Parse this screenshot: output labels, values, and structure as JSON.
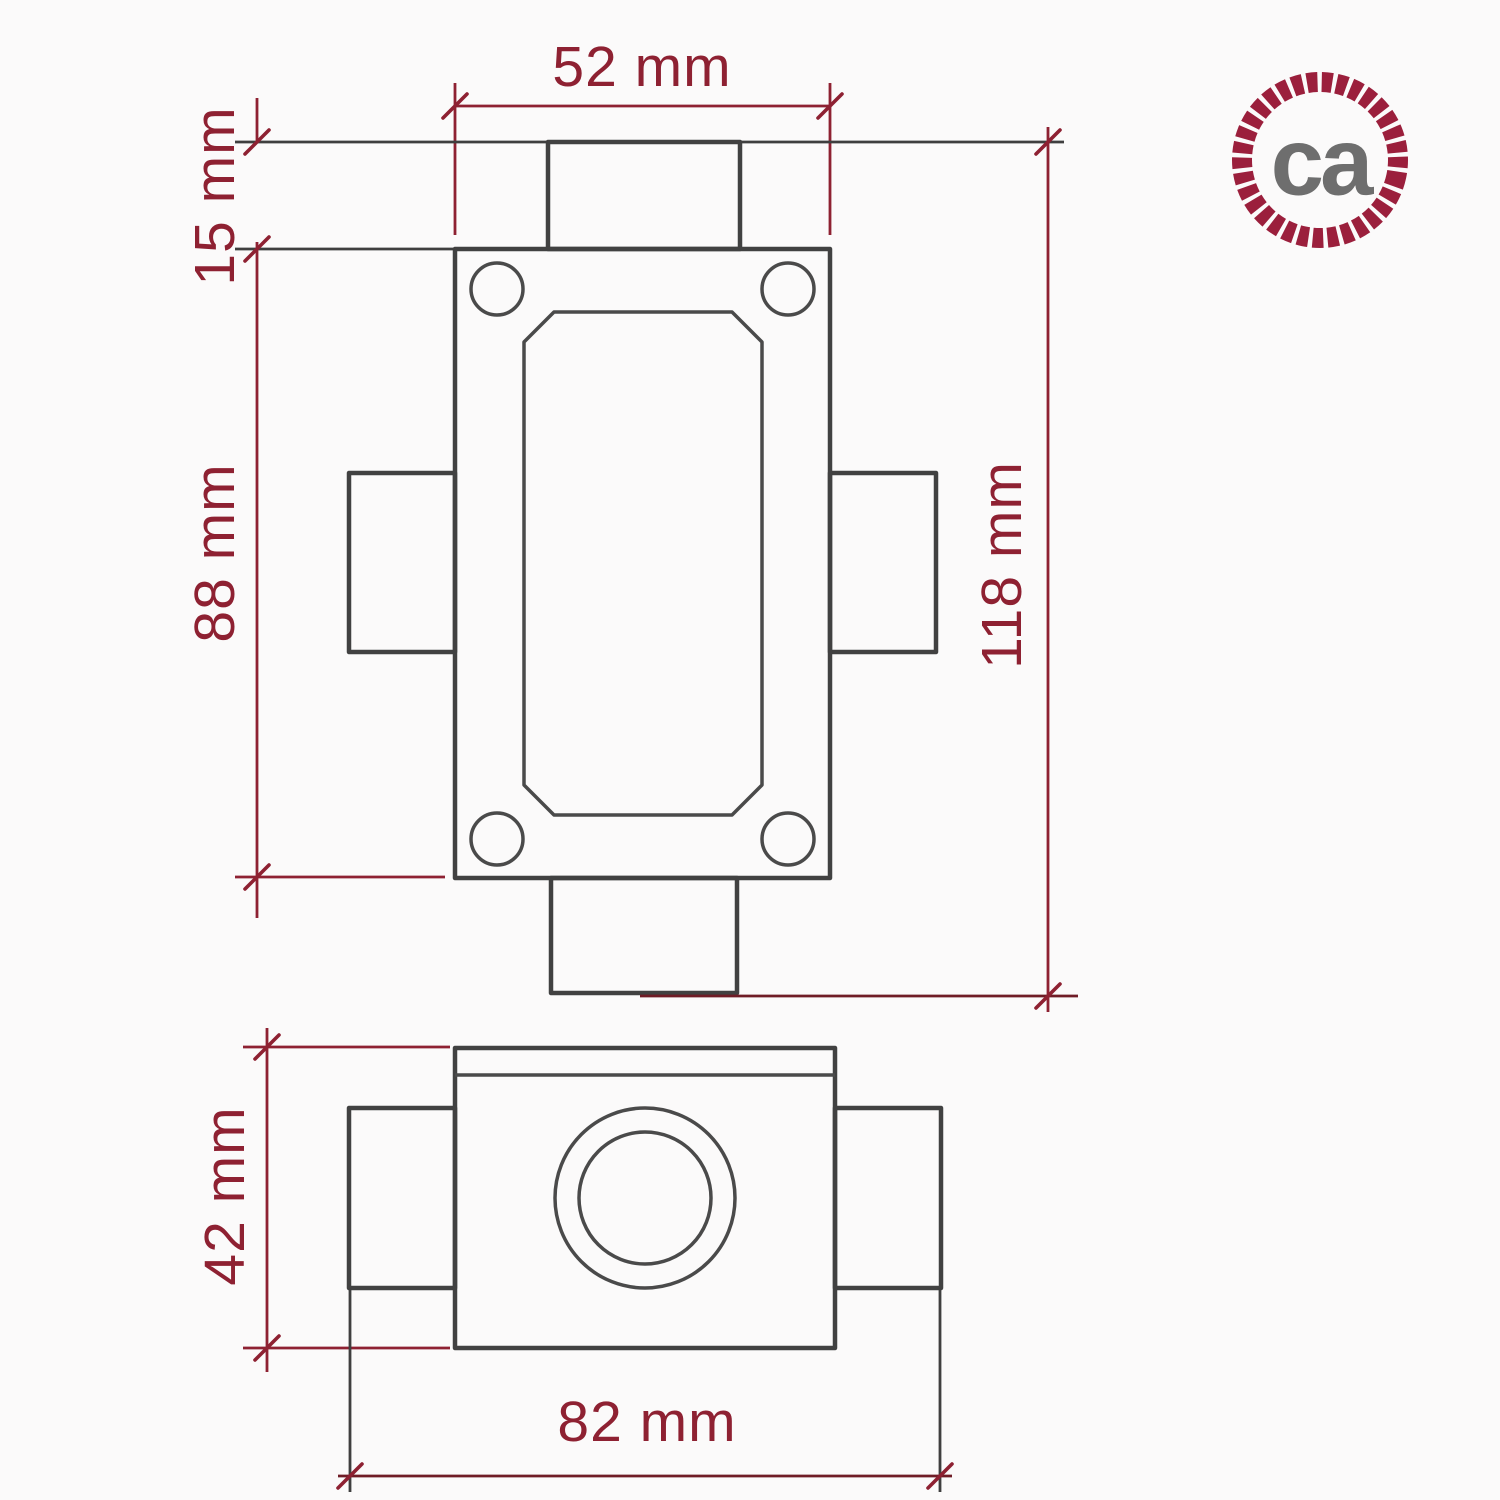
{
  "drawing_type": "technical-dimension-drawing",
  "colors": {
    "dimension_red": "#8e2132",
    "outline_gray": "#414141",
    "logo_ring_red": "#9b1f3c",
    "logo_text_gray": "#6e6e6e",
    "background": "#fbfafa"
  },
  "dimensions": {
    "body_width": "52 mm",
    "stub_protrusion": "15 mm",
    "body_height": "88 mm",
    "overall_height": "118 mm",
    "depth": "42 mm",
    "overall_width": "82 mm"
  },
  "logo": {
    "text": "ca"
  }
}
